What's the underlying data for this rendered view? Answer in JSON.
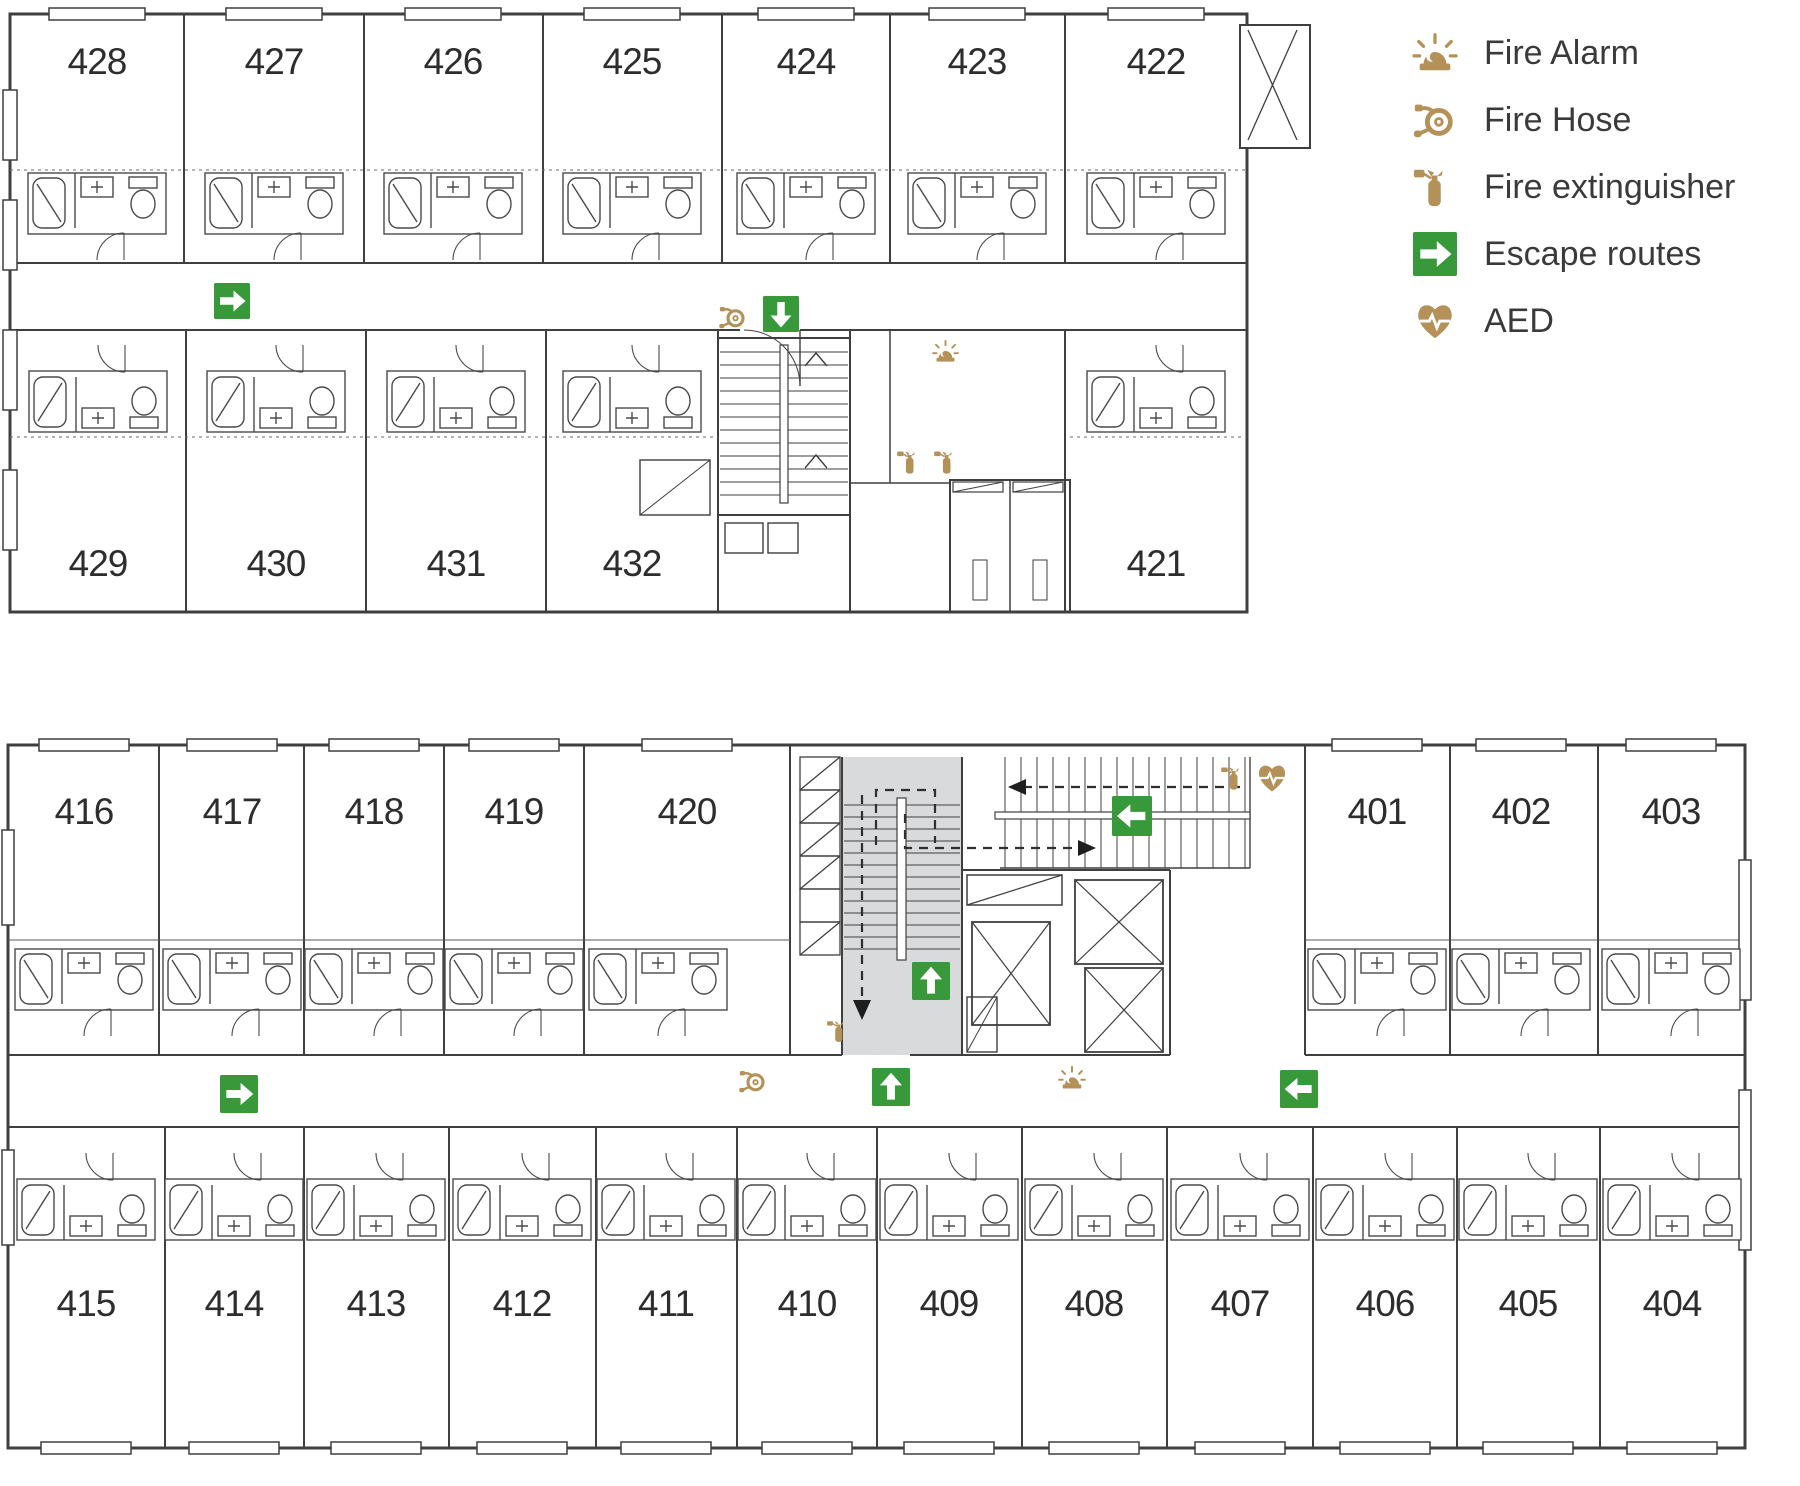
{
  "legend": {
    "items": [
      {
        "label": "Fire Alarm",
        "icon": "fire-alarm-icon"
      },
      {
        "label": "Fire Hose",
        "icon": "fire-hose-icon"
      },
      {
        "label": "Fire extinguisher",
        "icon": "fire-extinguisher-icon"
      },
      {
        "label": "Escape routes",
        "icon": "escape-route-icon"
      },
      {
        "label": "AED",
        "icon": "aed-icon"
      }
    ]
  },
  "floors": {
    "upper": {
      "top_row": [
        "428",
        "427",
        "426",
        "425",
        "424",
        "423",
        "422"
      ],
      "bottom_row": [
        "429",
        "430",
        "431",
        "432",
        "421"
      ]
    },
    "lower": {
      "top_row": [
        "416",
        "417",
        "418",
        "419",
        "420",
        "401",
        "402",
        "403"
      ],
      "bottom_row": [
        "415",
        "414",
        "413",
        "412",
        "411",
        "410",
        "409",
        "408",
        "407",
        "406",
        "405",
        "404"
      ]
    }
  },
  "colors": {
    "accent_tan": "#b5915a",
    "escape_green": "#38993b",
    "wall_line": "#3f3f3f",
    "stair_fill": "#d8dadb",
    "room_number_text": "#2d2d2d",
    "legend_text": "#3a3a3a"
  }
}
